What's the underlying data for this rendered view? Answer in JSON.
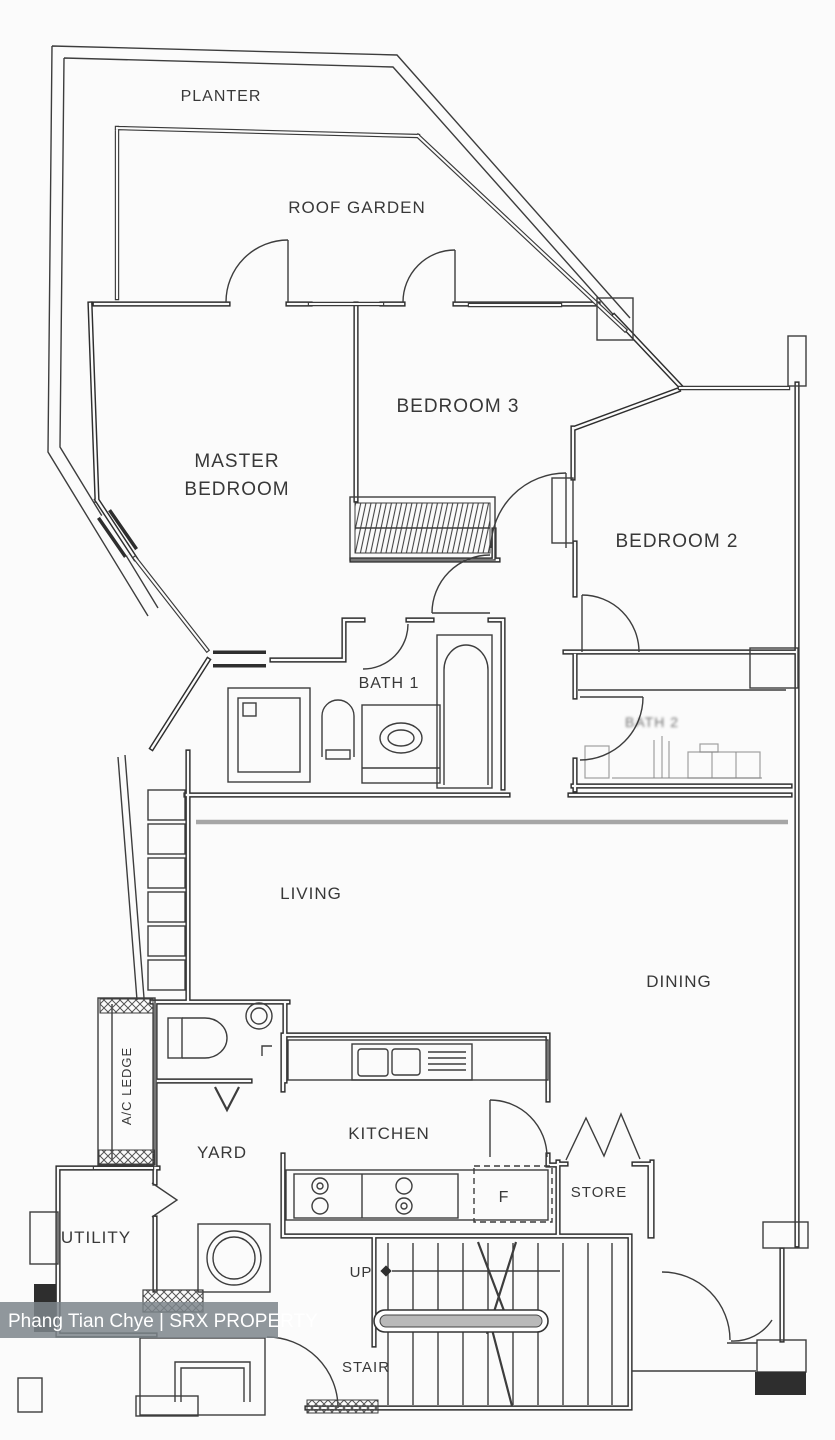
{
  "labels": {
    "planter": "PLANTER",
    "roof_garden": "ROOF GARDEN",
    "bedroom3": "BEDROOM 3",
    "master_line1": "MASTER",
    "master_line2": "BEDROOM",
    "bedroom2": "BEDROOM 2",
    "bath1": "BATH 1",
    "bath2_faint": "BATH 2",
    "living": "LIVING",
    "dining": "DINING",
    "ac_ledge": "A/C LEDGE",
    "yard": "YARD",
    "kitchen": "KITCHEN",
    "fridge": "F",
    "store": "STORE",
    "utility": "UTILITY",
    "up": "UP",
    "stair": "STAIR"
  },
  "watermark": {
    "text": "Phang Tian Chye | SRX PROPERTY",
    "text_color": "#ffffff",
    "band_color": "rgba(125,133,139,0.85)"
  },
  "colors": {
    "wall": "#2e2e2e",
    "thin_line": "#3d3d3d",
    "faint_fixture": "#8a8a8a",
    "beam": "#a6a6a6",
    "background": "#fbfbfb"
  }
}
